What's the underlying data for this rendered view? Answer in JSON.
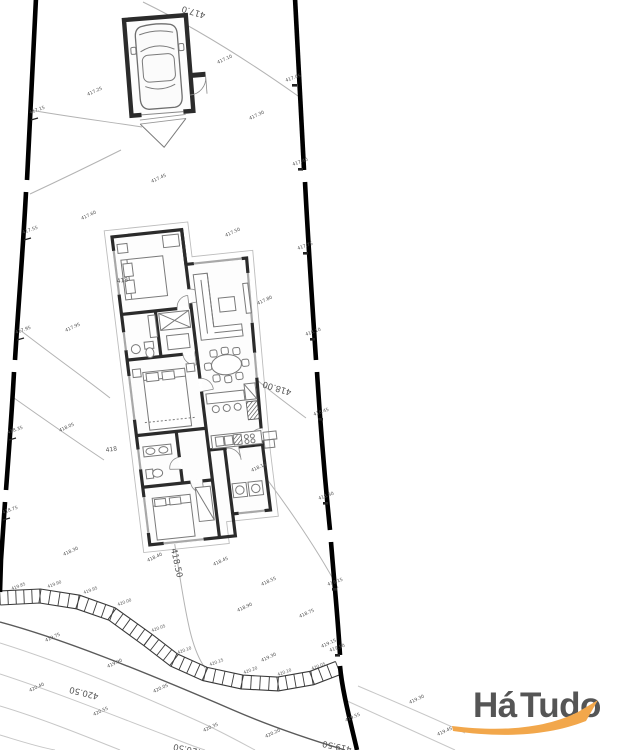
{
  "watermark": {
    "ha": "Há",
    "tudo": "Tudo",
    "ha_color": "#F0A355",
    "tudo_color": "#58A7E0",
    "swoosh_color": "#F2A74B"
  },
  "plan": {
    "colors": {
      "walls": "#2b2b2b",
      "boundary": "#000000",
      "contour": "#c7c7c7"
    },
    "contour_labels": [
      {
        "t": "417.0",
        "x": 206,
        "y": 13,
        "r": 197,
        "s": 8.5
      },
      {
        "t": "418.00",
        "x": 292,
        "y": 390,
        "r": 197,
        "s": 8.5
      },
      {
        "t": "418.50",
        "x": 171,
        "y": 549,
        "r": 78,
        "s": 8.5
      },
      {
        "t": "420.50",
        "x": 99,
        "y": 694,
        "r": 194,
        "s": 8.5
      },
      {
        "t": "420.50",
        "x": 203,
        "y": 750,
        "r": 192,
        "s": 8.5
      },
      {
        "t": "419.50",
        "x": 352,
        "y": 747,
        "r": 192,
        "s": 8.5
      }
    ],
    "level_markers": [
      {
        "t": "418",
        "x": 117,
        "y": 283,
        "r": -8,
        "s": 6,
        "c": "#333"
      },
      {
        "t": "418",
        "x": 106,
        "y": 452,
        "r": -8,
        "s": 6,
        "c": "#333"
      }
    ],
    "spot_labels": [
      {
        "t": "417.25",
        "x": 88,
        "y": 96,
        "r": -25
      },
      {
        "t": "417.10",
        "x": 218,
        "y": 64,
        "r": -25
      },
      {
        "t": "417.30",
        "x": 250,
        "y": 120,
        "r": -25
      },
      {
        "t": "417.45",
        "x": 152,
        "y": 183,
        "r": -25
      },
      {
        "t": "417.60",
        "x": 82,
        "y": 220,
        "r": -25
      },
      {
        "t": "417.50",
        "x": 226,
        "y": 237,
        "r": -25
      },
      {
        "t": "417.95",
        "x": 66,
        "y": 332,
        "r": -25
      },
      {
        "t": "417.80",
        "x": 258,
        "y": 305,
        "r": -25
      },
      {
        "t": "418.05",
        "x": 60,
        "y": 432,
        "r": -25
      },
      {
        "t": "418.15",
        "x": 252,
        "y": 472,
        "r": -25
      },
      {
        "t": "418.30",
        "x": 64,
        "y": 556,
        "r": -25
      },
      {
        "t": "418.40",
        "x": 148,
        "y": 562,
        "r": -25
      },
      {
        "t": "418.45",
        "x": 214,
        "y": 566,
        "r": -25
      },
      {
        "t": "418.55",
        "x": 262,
        "y": 586,
        "r": -25
      },
      {
        "t": "418.90",
        "x": 238,
        "y": 612,
        "r": -25
      },
      {
        "t": "418.75",
        "x": 300,
        "y": 618,
        "r": -25
      },
      {
        "t": "419.75",
        "x": 46,
        "y": 642,
        "r": -25
      },
      {
        "t": "419.90",
        "x": 108,
        "y": 668,
        "r": -25
      },
      {
        "t": "420.05",
        "x": 154,
        "y": 693,
        "r": -25
      },
      {
        "t": "419.30",
        "x": 262,
        "y": 662,
        "r": -25
      },
      {
        "t": "419.15",
        "x": 322,
        "y": 648,
        "r": -25
      },
      {
        "t": "420.40",
        "x": 30,
        "y": 692,
        "r": -25
      },
      {
        "t": "420.55",
        "x": 94,
        "y": 716,
        "r": -25
      },
      {
        "t": "420.35",
        "x": 204,
        "y": 732,
        "r": -25
      },
      {
        "t": "420.20",
        "x": 266,
        "y": 738,
        "r": -25
      },
      {
        "t": "419.30",
        "x": 410,
        "y": 704,
        "r": -25
      },
      {
        "t": "419.45",
        "x": 438,
        "y": 736,
        "r": -25
      },
      {
        "t": "419.55",
        "x": 346,
        "y": 722,
        "r": -25
      }
    ],
    "boundary_labels": [
      {
        "t": "417.15",
        "x": 30,
        "y": 114,
        "r": -20
      },
      {
        "t": "417.55",
        "x": 23,
        "y": 234,
        "r": -20
      },
      {
        "t": "417.95",
        "x": 16,
        "y": 334,
        "r": -20
      },
      {
        "t": "418.35",
        "x": 8,
        "y": 434,
        "r": -20
      },
      {
        "t": "418.75",
        "x": 3,
        "y": 514,
        "r": -20
      },
      {
        "t": "417.05",
        "x": 286,
        "y": 82,
        "r": -20
      },
      {
        "t": "417.40",
        "x": 293,
        "y": 166,
        "r": -20
      },
      {
        "t": "417.75",
        "x": 298,
        "y": 250,
        "r": -20
      },
      {
        "t": "418.10",
        "x": 306,
        "y": 336,
        "r": -20
      },
      {
        "t": "418.45",
        "x": 314,
        "y": 416,
        "r": -20
      },
      {
        "t": "418.80",
        "x": 319,
        "y": 500,
        "r": -20
      },
      {
        "t": "419.15",
        "x": 328,
        "y": 586,
        "r": -20
      },
      {
        "t": "419.50",
        "x": 330,
        "y": 652,
        "r": -20
      }
    ],
    "band_labels": [
      {
        "t": "419.85",
        "x": 12,
        "y": 590,
        "r": -20
      },
      {
        "t": "419.90",
        "x": 48,
        "y": 588,
        "r": -20
      },
      {
        "t": "419.95",
        "x": 84,
        "y": 594,
        "r": -20
      },
      {
        "t": "420.00",
        "x": 118,
        "y": 606,
        "r": -20
      },
      {
        "t": "420.05",
        "x": 152,
        "y": 632,
        "r": -20
      },
      {
        "t": "420.10",
        "x": 178,
        "y": 654,
        "r": -20
      },
      {
        "t": "420.15",
        "x": 210,
        "y": 666,
        "r": -20
      },
      {
        "t": "420.20",
        "x": 244,
        "y": 674,
        "r": -20
      },
      {
        "t": "420.10",
        "x": 278,
        "y": 676,
        "r": -20
      },
      {
        "t": "420.05",
        "x": 312,
        "y": 670,
        "r": -20
      }
    ]
  }
}
